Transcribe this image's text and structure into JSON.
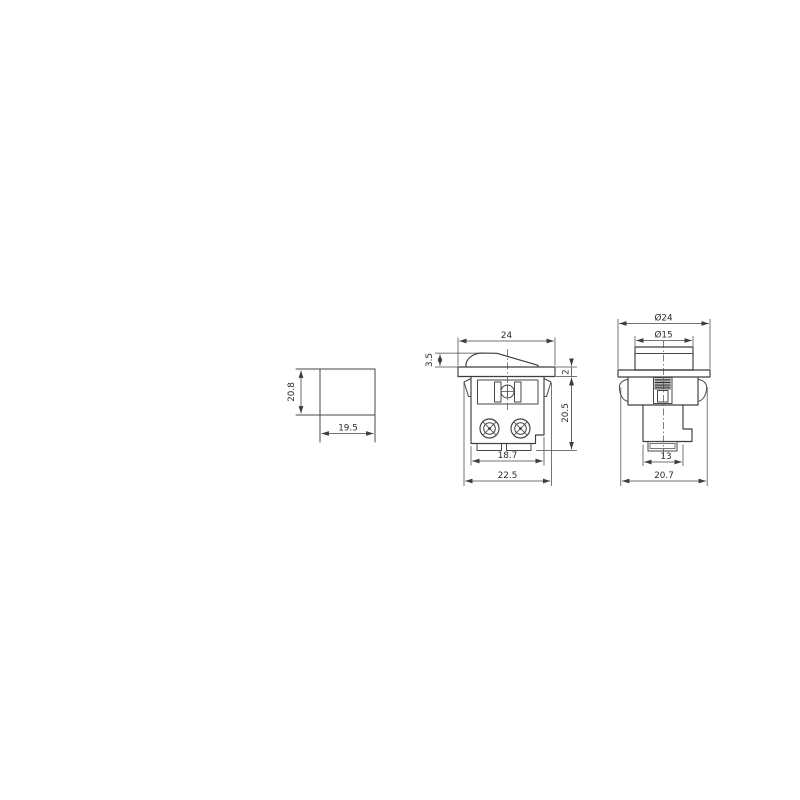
{
  "drawing": {
    "kind": "rocker-switch-dimension-drawing",
    "line_color": "#3e3e3e",
    "background": "#ffffff",
    "panel_cutout_view": {
      "height": "20.8",
      "width": "19.5"
    },
    "front_view": {
      "flange_width": "24",
      "rocker_height": "3.5",
      "flange_thickness": "2",
      "body_depth": "20.5",
      "terminal_span": "18.7",
      "overall_width": "22.5"
    },
    "side_view": {
      "flange_diameter": "Ø24",
      "rocker_diameter": "Ø15",
      "terminal_width": "13",
      "overall_width": "20.7"
    }
  }
}
